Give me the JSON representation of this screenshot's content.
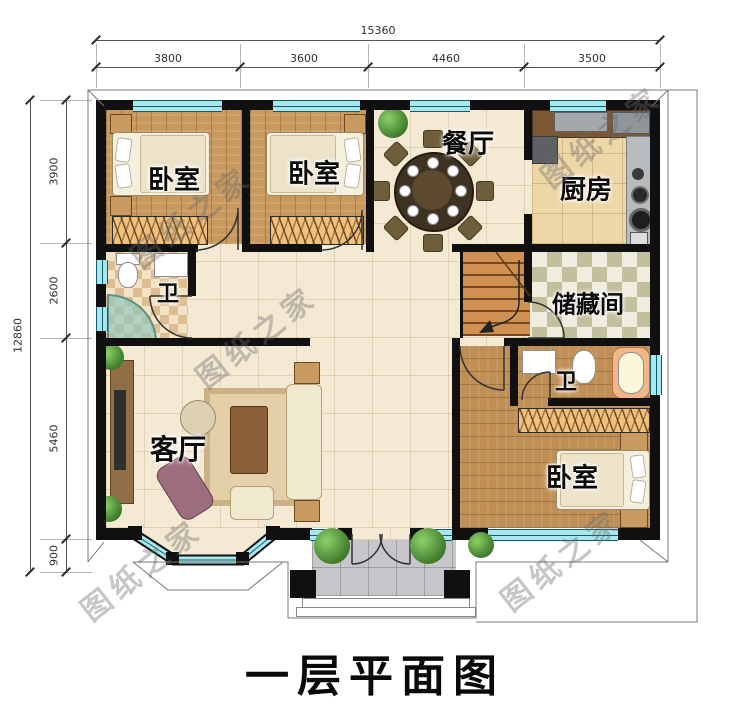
{
  "title": "一层平面图",
  "watermark": "图纸之家",
  "dimensions": {
    "top_total": "15360",
    "top_segments": [
      "3800",
      "3600",
      "4460",
      "3500"
    ],
    "left_total": "12860",
    "left_segments": [
      "3900",
      "2600",
      "5460",
      "900"
    ]
  },
  "rooms": {
    "bedroom_top_left": "卧室",
    "bedroom_top_mid": "卧室",
    "dining": "餐厅",
    "kitchen": "厨房",
    "bath_left": "卫",
    "storage": "储藏间",
    "living": "客厅",
    "bath_right": "卫",
    "bedroom_bottom_right": "卧室"
  },
  "colors": {
    "wall": "#101010",
    "window": "#a9e6ee",
    "hall_floor": "#f4e9d3",
    "wood_floor": "#c8995d",
    "watermark_gray": "#696969"
  }
}
